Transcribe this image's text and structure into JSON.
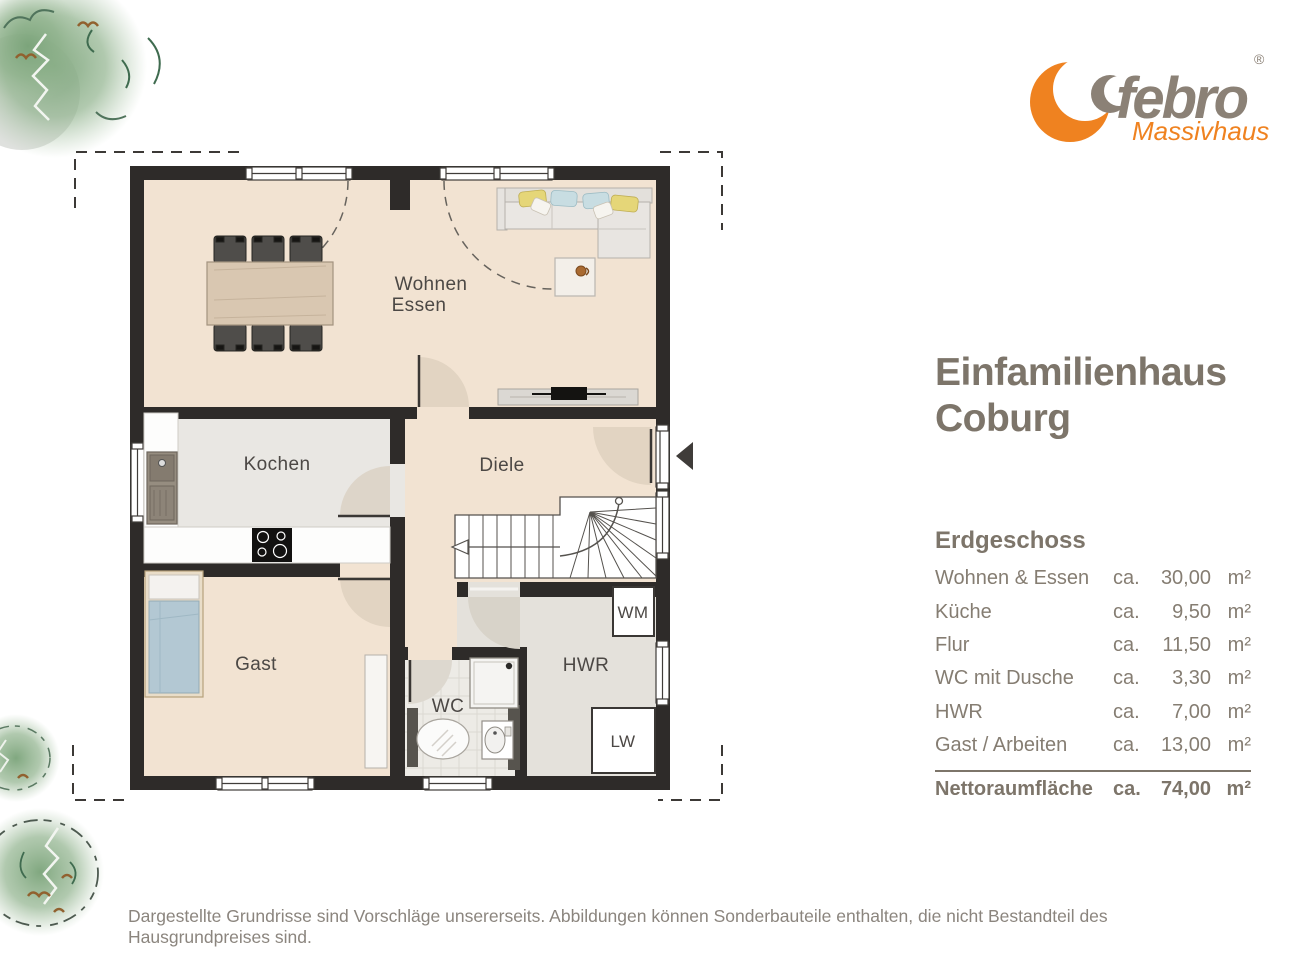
{
  "logo": {
    "brand": "febro",
    "registered": "®",
    "subtitle": "Massivhaus"
  },
  "title": {
    "line1": "Einfamilienhaus",
    "line2": "Coburg"
  },
  "areas": {
    "heading": "Erdgeschoss",
    "rows": [
      {
        "label": "Wohnen & Essen",
        "ca": "ca.",
        "value": "30,00",
        "unit": "m²"
      },
      {
        "label": "Küche",
        "ca": "ca.",
        "value": "9,50",
        "unit": "m²"
      },
      {
        "label": "Flur",
        "ca": "ca.",
        "value": "11,50",
        "unit": "m²"
      },
      {
        "label": "WC mit Dusche",
        "ca": "ca.",
        "value": "3,30",
        "unit": "m²"
      },
      {
        "label": "HWR",
        "ca": "ca.",
        "value": "7,00",
        "unit": "m²"
      },
      {
        "label": "Gast / Arbeiten",
        "ca": "ca.",
        "value": "13,00",
        "unit": "m²"
      }
    ],
    "total": {
      "label": "Nettoraumfläche",
      "ca": "ca.",
      "value": "74,00",
      "unit": "m²"
    }
  },
  "plan": {
    "labels": {
      "wohnen": "Wohnen",
      "essen": "Essen",
      "kochen": "Kochen",
      "diele": "Diele",
      "gast": "Gast",
      "wc": "WC",
      "hwr": "HWR",
      "wm": "WM",
      "lw": "LW"
    }
  },
  "footer": {
    "disclaimer": "Dargestellte Grundrisse sind Vorschläge unsererseits. Abbildungen können Sonderbauteile enthalten, die nicht Bestandteil des Hausgrundpreises sind."
  },
  "colors": {
    "accent_orange": "#ef8220",
    "text_taupe": "#7d756a",
    "wall": "#2e2b29",
    "floor_beige": "#f2e3d2",
    "floor_gray": "#e9e7e3",
    "door_swing": "#e2d4c2"
  }
}
